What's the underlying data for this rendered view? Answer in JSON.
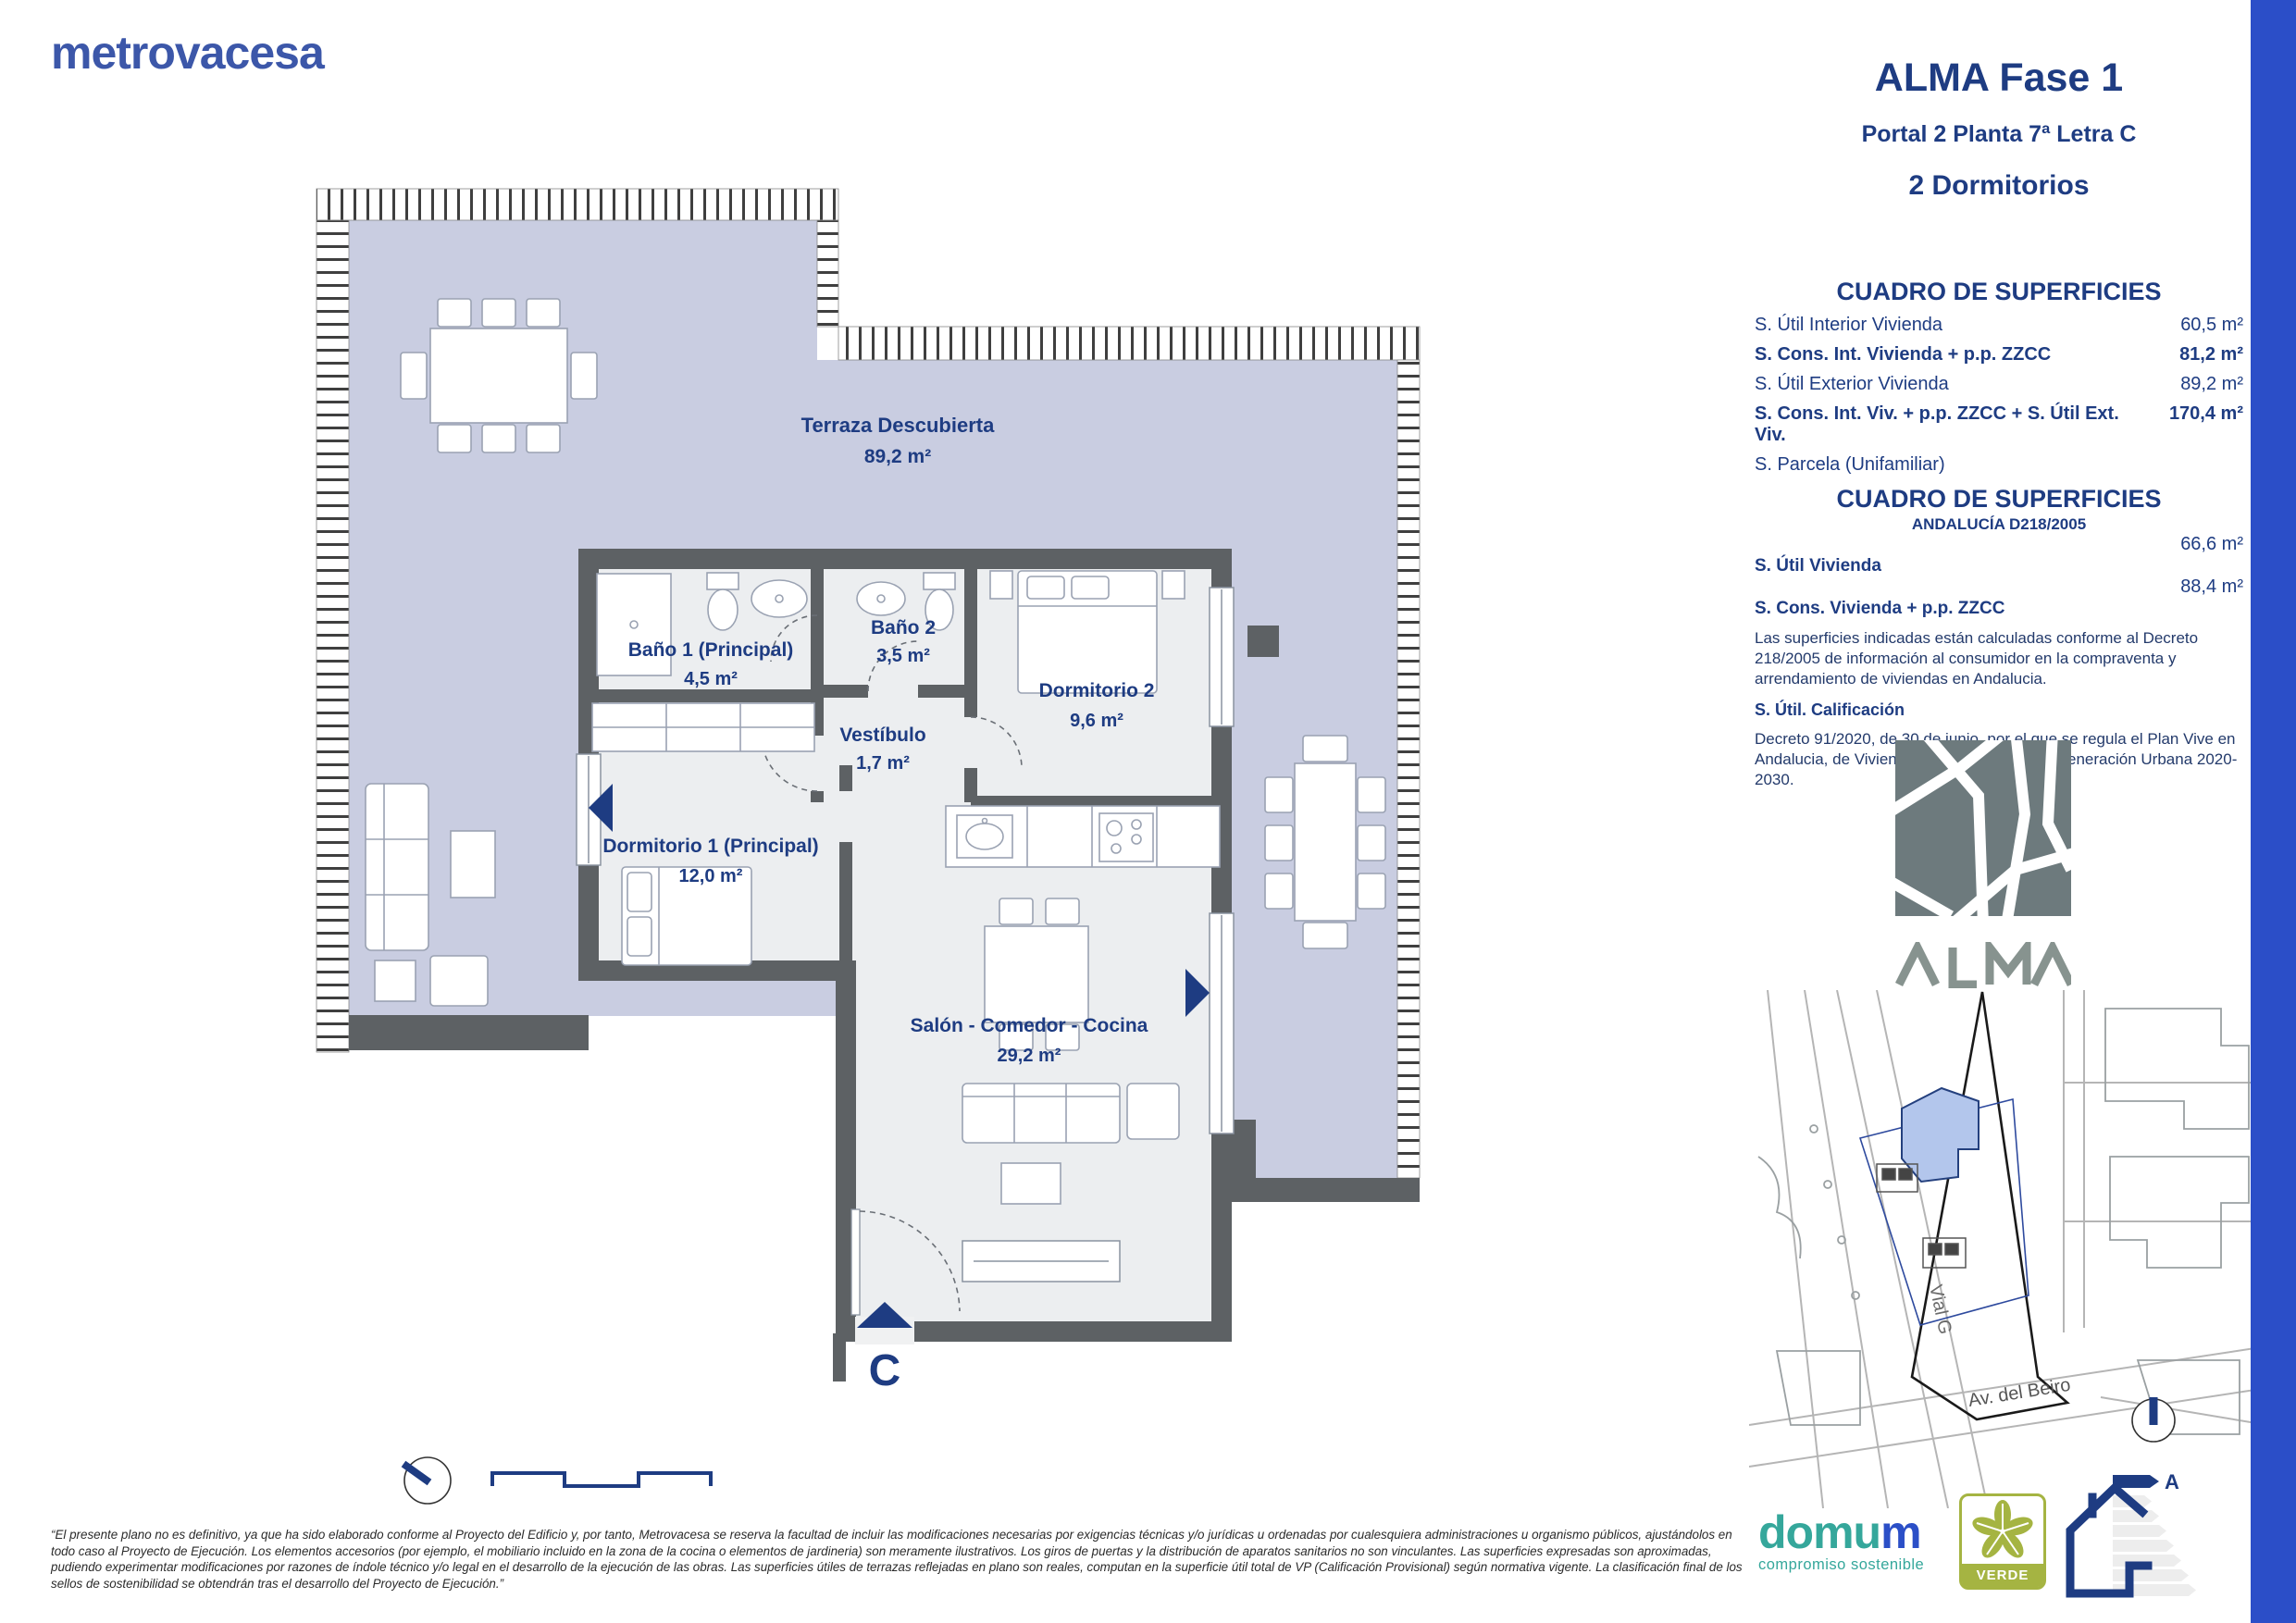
{
  "page": {
    "brand": "metrovacesa",
    "title": "ALMA Fase 1",
    "subtitle": "Portal 2 Planta 7ª Letra C",
    "bedrooms": "2 Dormitorios"
  },
  "surfaces": {
    "title": "CUADRO DE SUPERFICIES",
    "rows": [
      {
        "label": "S. Útil Interior Vivienda",
        "value": "60,5 m²"
      },
      {
        "label": "S. Cons. Int. Vivienda + p.p. ZZCC",
        "value": "81,2 m²"
      },
      {
        "label": "S. Útil Exterior Vivienda",
        "value": "89,2 m²"
      },
      {
        "label": "S. Cons. Int. Viv. + p.p. ZZCC + S. Útil Ext. Viv.",
        "value": "170,4 m²"
      },
      {
        "label": "S. Parcela (Unifamiliar)",
        "value": ""
      }
    ]
  },
  "surfaces_andalucia": {
    "title": "CUADRO DE SUPERFICIES",
    "subtitle": "ANDALUCÍA D218/2005",
    "rows": [
      {
        "label": "S. Útil Vivienda",
        "value": "66,6 m²"
      },
      {
        "label": "S. Cons. Vivienda + p.p. ZZCC",
        "value": "88,4 m²"
      }
    ],
    "note1": "Las superficies indicadas están calculadas conforme al Decreto 218/2005 de información al consumidor en la compraventa y arrendamiento de viviendas en Andalucia.",
    "calification_label": "S. Útil. Calificación",
    "note2": "Decreto 91/2020, de 30 de junio, por el que se regula el Plan Vive en Andalucia, de Vivienda, Rehabilitación y Regeneración Urbana 2020-2030."
  },
  "plan": {
    "rooms": [
      {
        "name": "Terraza Descubierta",
        "area": "89,2 m²"
      },
      {
        "name": "Baño 1 (Principal)",
        "area": "4,5 m²"
      },
      {
        "name": "Baño 2",
        "area": "3,5 m²"
      },
      {
        "name": "Dormitorio 2",
        "area": "9,6 m²"
      },
      {
        "name": "Vestíbulo",
        "area": "1,7 m²"
      },
      {
        "name": "Dormitorio 1 (Principal)",
        "area": "12,0 m²"
      },
      {
        "name": "Salón - Comedor - Cocina",
        "area": "29,2 m²"
      }
    ],
    "entrance_letter": "C"
  },
  "site_map": {
    "project": "ALMA",
    "street1": "Vial G",
    "street2": "Av. del Beiro"
  },
  "footer": {
    "disclaimer": "“El presente plano no es definitivo, ya que ha sido elaborado conforme al Proyecto del Edificio y, por tanto, Metrovacesa se reserva la facultad de incluir las modificaciones necesarias por exigencias técnicas y/o jurídicas u ordenadas por cualesquiera administraciones u organismo públicos, ajustándolos en todo caso al Proyecto de Ejecución. Los elementos accesorios (por ejemplo, el mobiliario incluido en la zona de la cocina o elementos de jardineria) son meramente ilustrativos. Los giros de puertas y la distribución de aparatos sanitarios no son vinculantes. Las superficies expresadas son aproximadas, pudiendo experimentar modificaciones por razones de índole técnico y/o legal en el desarrollo de la ejecución de las obras. Las superficies útiles de terrazas reflejadas en plano son reales, computan en la superficie útil total de VP (Calificación Provisional) según normativa vigente. La clasificación final de los sellos de sostenibilidad se obtendrán tras el desarrollo del Proyecto de Ejecución.”",
    "domum_part1": "domu",
    "domum_part2": "m",
    "domum_tagline": "compromiso sostenible",
    "verde_label": "VERDE",
    "energy_rating": "A"
  },
  "colors": {
    "navy": "#1e3c82",
    "brand_blue": "#3c57a9",
    "side_bar_blue": "#2b4ec8",
    "terrace": "#c9cde1",
    "wall": "#5d6164",
    "floor": "#eceef0",
    "map_gray": "#6d7a7d",
    "verde_green": "#a5b442",
    "domum_teal": "#35a79b"
  }
}
